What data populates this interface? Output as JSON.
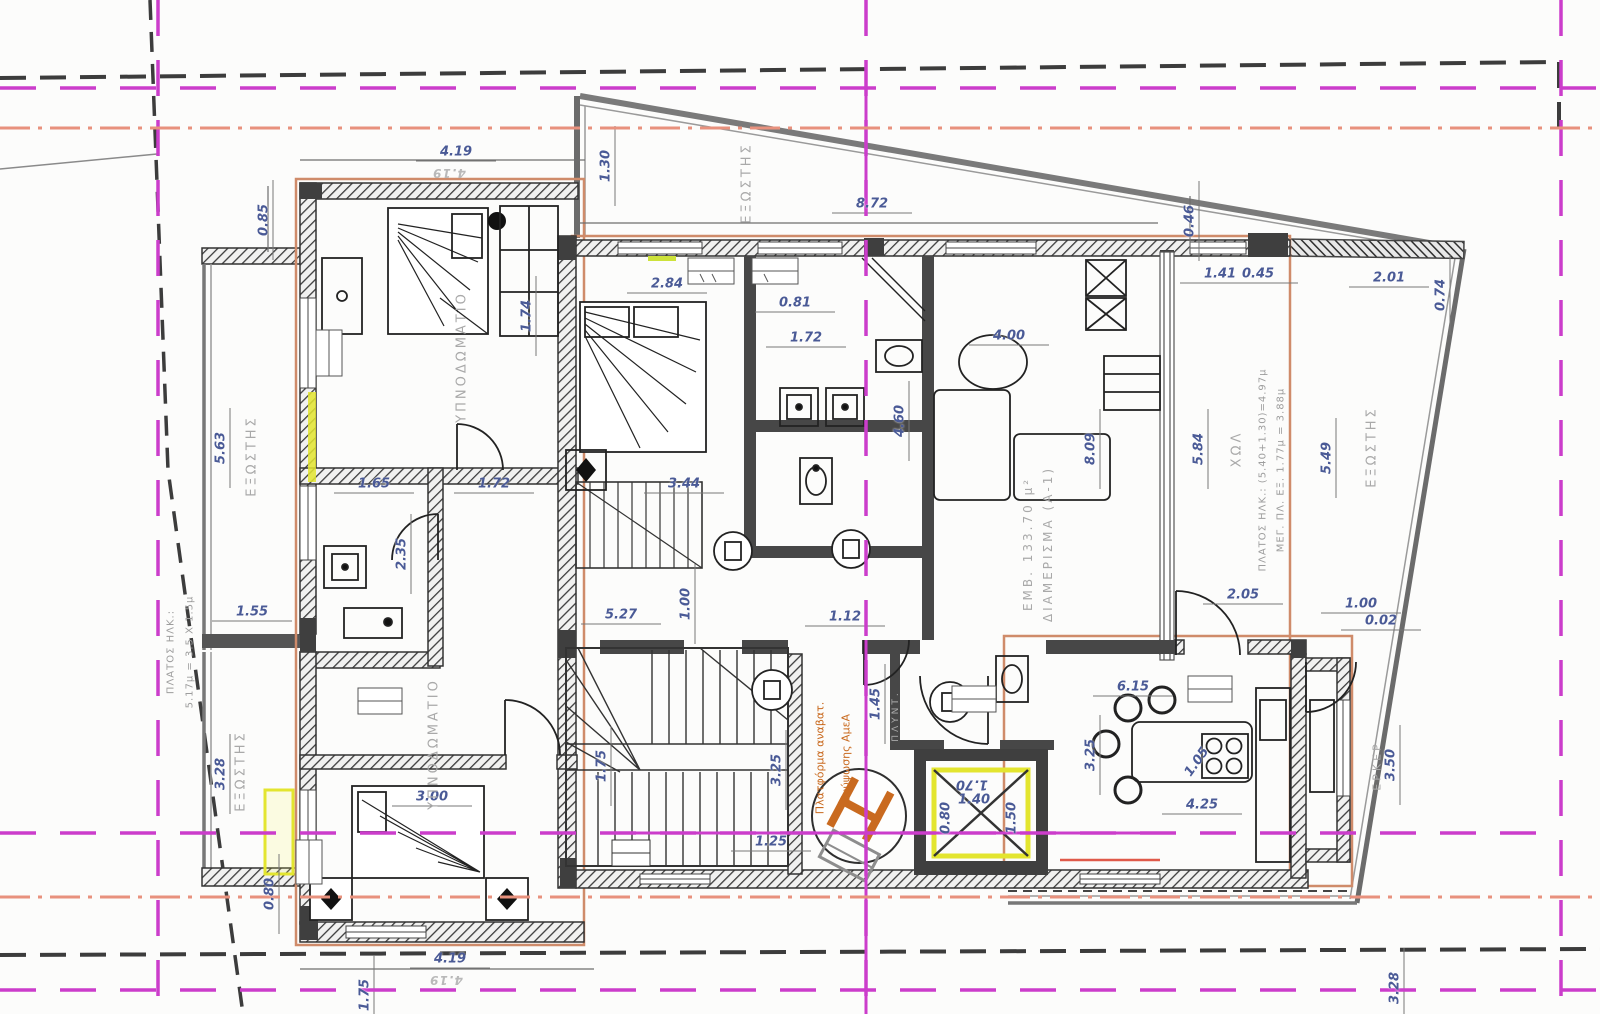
{
  "colors": {
    "grid_magenta": "#cb3dcb",
    "grid_salmon": "#e8917d",
    "construction_black": "#3c3c3c",
    "building_offset_orange": "#cf8b6a",
    "wall_fill": "#3f3f3f",
    "highlight_yellow": "#e3e52f",
    "lift_orange": "#c96a1f",
    "dimension_text": "#4a5a96",
    "label_gray": "#a9a9a9"
  },
  "dimensions": [
    {
      "text": "4.19",
      "x": 456,
      "y": 152
    },
    {
      "text": "0.85",
      "x": 264,
      "y": 220,
      "rot": -90
    },
    {
      "text": "1.30",
      "x": 606,
      "y": 166,
      "rot": -90
    },
    {
      "text": "8.72",
      "x": 872,
      "y": 204
    },
    {
      "text": "2.84",
      "x": 667,
      "y": 284
    },
    {
      "text": "0.81",
      "x": 795,
      "y": 303
    },
    {
      "text": "1.72",
      "x": 806,
      "y": 338
    },
    {
      "text": "1.41",
      "x": 1220,
      "y": 274
    },
    {
      "text": "0.45",
      "x": 1258,
      "y": 274
    },
    {
      "text": "2.01",
      "x": 1389,
      "y": 278
    },
    {
      "text": "0.46",
      "x": 1190,
      "y": 221,
      "rot": -90
    },
    {
      "text": "0.74",
      "x": 1441,
      "y": 295,
      "rot": -90
    },
    {
      "text": "1.74",
      "x": 527,
      "y": 316,
      "rot": -90
    },
    {
      "text": "4.00",
      "x": 1009,
      "y": 336
    },
    {
      "text": "4.60",
      "x": 900,
      "y": 421,
      "rot": -90
    },
    {
      "text": "8.09",
      "x": 1091,
      "y": 449,
      "rot": -90
    },
    {
      "text": "5.84",
      "x": 1199,
      "y": 449,
      "rot": -90
    },
    {
      "text": "5.49",
      "x": 1327,
      "y": 458,
      "rot": -90
    },
    {
      "text": "1.65",
      "x": 374,
      "y": 484
    },
    {
      "text": "1.72",
      "x": 494,
      "y": 484
    },
    {
      "text": "3.44",
      "x": 684,
      "y": 484
    },
    {
      "text": "2.35",
      "x": 402,
      "y": 554,
      "rot": -90
    },
    {
      "text": "1.55",
      "x": 252,
      "y": 612
    },
    {
      "text": "5.27",
      "x": 621,
      "y": 615
    },
    {
      "text": "1.00",
      "x": 686,
      "y": 604,
      "rot": -90
    },
    {
      "text": "1.12",
      "x": 845,
      "y": 617
    },
    {
      "text": "2.05",
      "x": 1243,
      "y": 595
    },
    {
      "text": "1.00",
      "x": 1361,
      "y": 604
    },
    {
      "text": "0.02",
      "x": 1381,
      "y": 621
    },
    {
      "text": "5.63",
      "x": 221,
      "y": 448,
      "rot": -90
    },
    {
      "text": "3.28",
      "x": 221,
      "y": 774,
      "rot": -90
    },
    {
      "text": "3.00",
      "x": 432,
      "y": 797
    },
    {
      "text": "0.80",
      "x": 270,
      "y": 894,
      "rot": -90
    },
    {
      "text": "1.75",
      "x": 602,
      "y": 766,
      "rot": -90
    },
    {
      "text": "1.45",
      "x": 876,
      "y": 704,
      "rot": -90
    },
    {
      "text": "3.25",
      "x": 777,
      "y": 770,
      "rot": -90
    },
    {
      "text": "1.25",
      "x": 771,
      "y": 842
    },
    {
      "text": "1.70",
      "x": 972,
      "y": 784,
      "flip": true,
      "noline": true
    },
    {
      "text": "1.40",
      "x": 974,
      "y": 800,
      "noline": true
    },
    {
      "text": "0.80",
      "x": 946,
      "y": 818,
      "rot": -90,
      "noline": true
    },
    {
      "text": "1.50",
      "x": 1012,
      "y": 818,
      "rot": -90,
      "noline": true
    },
    {
      "text": "6.15",
      "x": 1133,
      "y": 687
    },
    {
      "text": "3.25",
      "x": 1091,
      "y": 755,
      "rot": -90
    },
    {
      "text": "1.05",
      "x": 1197,
      "y": 762,
      "rot": -55,
      "noline": true
    },
    {
      "text": "4.25",
      "x": 1202,
      "y": 805
    },
    {
      "text": "3.50",
      "x": 1391,
      "y": 765,
      "rot": -90
    },
    {
      "text": "3.28",
      "x": 1395,
      "y": 988,
      "rot": -90
    },
    {
      "text": "1.75",
      "x": 365,
      "y": 995,
      "rot": -90
    },
    {
      "text": "4.19",
      "x": 450,
      "y": 959
    }
  ],
  "room_labels": [
    {
      "text": "ΥΠΝΟΔΩΜΑΤΙΟ",
      "x": 462,
      "y": 357,
      "rot": -90
    },
    {
      "text": "ΥΠΝΟΔΩΜΑΤΙΟ",
      "x": 434,
      "y": 744,
      "rot": -90
    },
    {
      "text": "ΕΞΩΣΤΗΣ",
      "x": 747,
      "y": 183,
      "rot": -90
    },
    {
      "text": "ΕΞΩΣΤΗΣ",
      "x": 252,
      "y": 456,
      "rot": -90
    },
    {
      "text": "ΕΞΩΣΤΗΣ",
      "x": 241,
      "y": 771,
      "rot": -90
    },
    {
      "text": "ΕΞΩΣΤΗΣ",
      "x": 1372,
      "y": 447,
      "rot": -90
    },
    {
      "text": "ΧΩΛ",
      "x": 1237,
      "y": 449,
      "rot": -90
    },
    {
      "text": "ΕΡΚΕΡ",
      "x": 1377,
      "y": 766,
      "rot": -90,
      "size": 11
    },
    {
      "text": "ΔΙΑΜΕΡΙΣΜΑ (Α-1)",
      "x": 1048,
      "y": 544,
      "rot": -90,
      "size": 12
    },
    {
      "text": "ΕΜΒ. 133.70 μ²",
      "x": 1028,
      "y": 544,
      "rot": -90,
      "size": 12
    },
    {
      "text": "ΠΛΥΝΤ.",
      "x": 896,
      "y": 716,
      "rot": -90,
      "size": 9
    }
  ],
  "annotations": [
    {
      "text": "ΠΛΑΤΟΣ ΗΛΚ.:",
      "x": 171,
      "y": 652,
      "rot": -90
    },
    {
      "text": "5.17μ = 3.5 Χ 1.5μ",
      "x": 190,
      "y": 652,
      "rot": -90
    },
    {
      "text": "ΠΛΑΤΟΣ ΗΛΚ.: (5.40+1.30)=4.97μ",
      "x": 1263,
      "y": 470,
      "rot": -90
    },
    {
      "text": "ΜΕΓ. ΠΛ. ΕΞ. 1.77μ = 3.88μ",
      "x": 1281,
      "y": 470,
      "rot": -90
    },
    {
      "text": "Πλατφόρμα αναβατ.",
      "x": 820,
      "y": 758,
      "rot": -90,
      "cls": "orange"
    },
    {
      "text": "ανύψωσης ΑμεΑ",
      "x": 846,
      "y": 758,
      "rot": -90,
      "cls": "orange"
    },
    {
      "text": "4.19",
      "x": 449,
      "y": 173,
      "flip": true,
      "cls": "ghost"
    },
    {
      "text": "4.19",
      "x": 446,
      "y": 980,
      "flip": true,
      "cls": "ghost"
    }
  ]
}
